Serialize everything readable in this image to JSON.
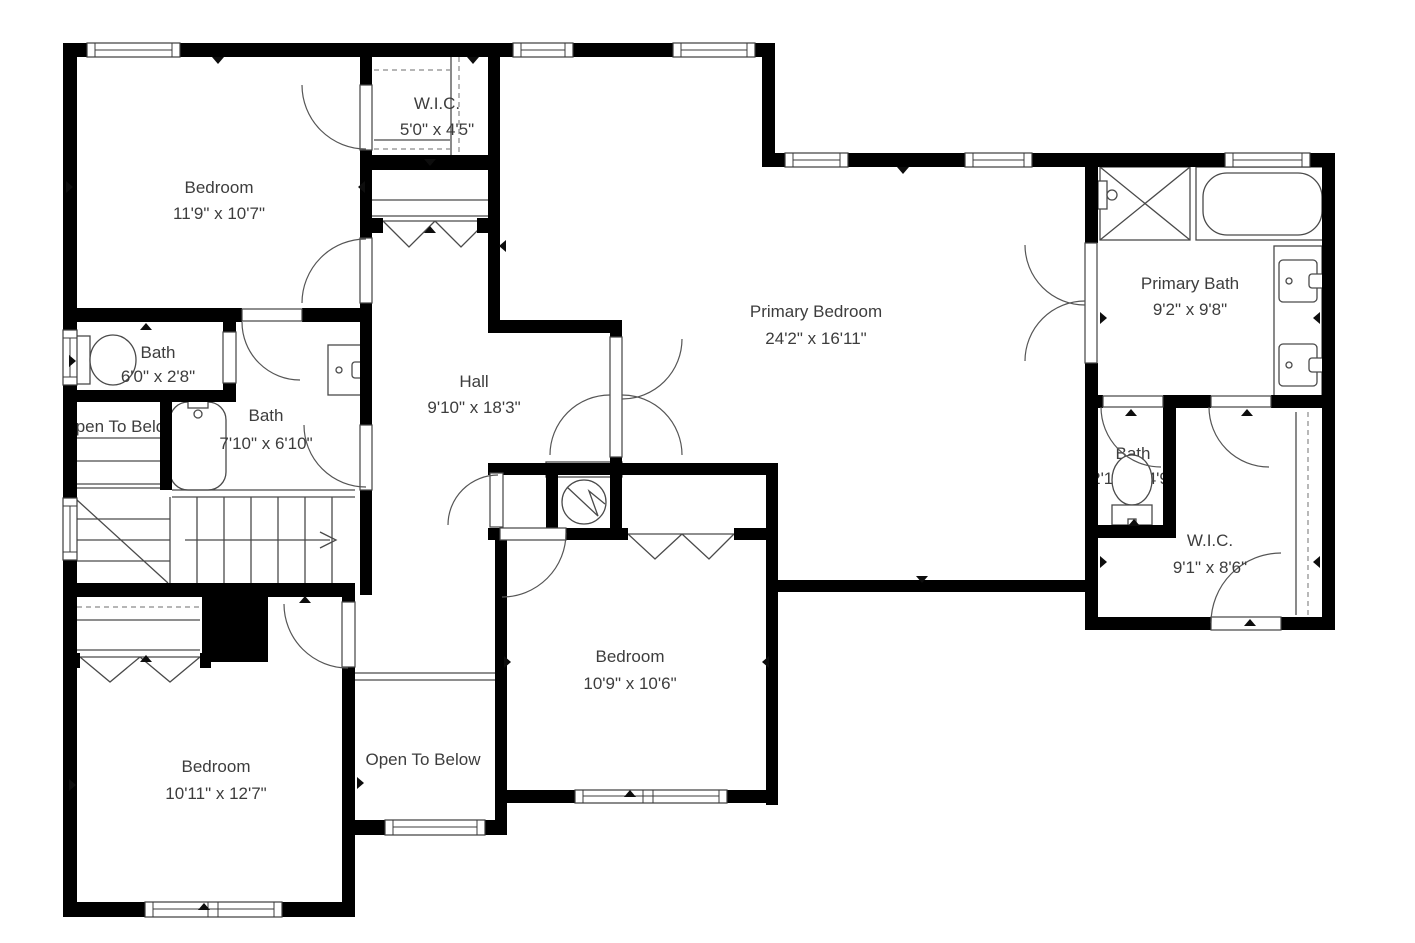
{
  "title": "Second floor plan",
  "colors": {
    "wall": "#000000",
    "line": "#4a4a4a",
    "text": "#3d3d3d",
    "background": "#ffffff"
  },
  "rooms": {
    "bedroom_tl": {
      "name": "Bedroom",
      "dims": "11'9\" x 10'7\""
    },
    "wic_top": {
      "name": "W.I.C.",
      "dims": "5'0\" x 4'5\""
    },
    "primary_bedroom": {
      "name": "Primary Bedroom",
      "dims": "24'2\" x 16'11\""
    },
    "primary_bath": {
      "name": "Primary Bath",
      "dims": "9'2\" x 9'8\""
    },
    "bath_left_small": {
      "name": "Bath",
      "dims": "6'0\" x 2'8\""
    },
    "bath_left": {
      "name": "Bath",
      "dims": "7'10\" x 6'10\""
    },
    "hall": {
      "name": "Hall",
      "dims": "9'10\" x 18'3\""
    },
    "open_below_left": {
      "name": "Open To Below"
    },
    "bath_right_small": {
      "name": "Bath",
      "dims": "2'10\" x 4'9\""
    },
    "wic_right": {
      "name": "W.I.C.",
      "dims": "9'1\" x 8'6\""
    },
    "bedroom_mid": {
      "name": "Bedroom",
      "dims": "10'9\" x 10'6\""
    },
    "bedroom_bl": {
      "name": "Bedroom",
      "dims": "10'11\" x 12'7\""
    },
    "open_below_bottom": {
      "name": "Open To Below"
    }
  }
}
